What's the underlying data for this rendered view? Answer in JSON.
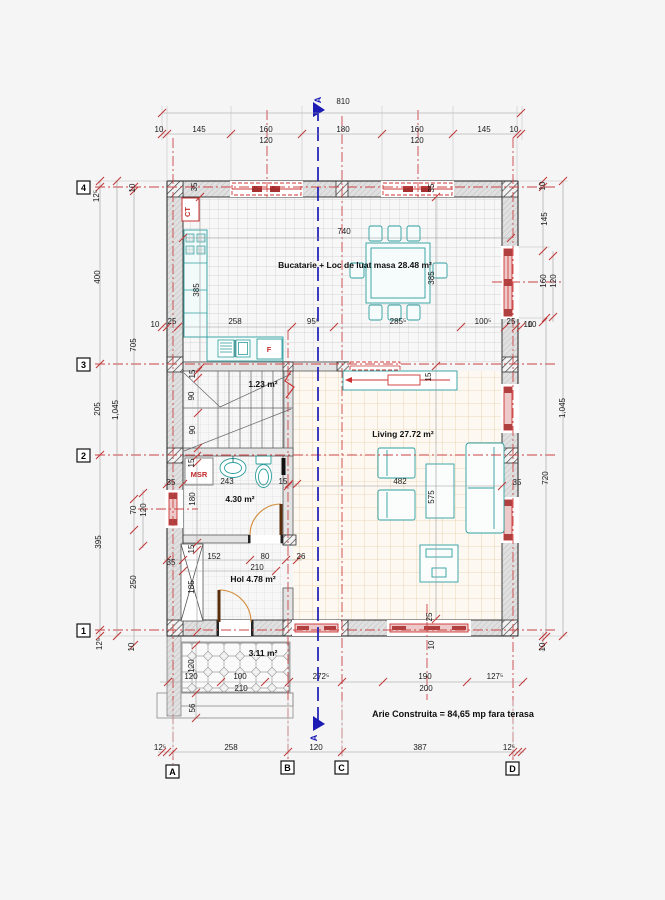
{
  "colors": {
    "axis_red": "#c23a3a",
    "section_blue": "#1c1cb4",
    "furniture_teal": "#2e9e9e",
    "door_orange": "#d28a36",
    "wall_gray": "#e0e0e0"
  },
  "rooms": {
    "kitchen": "Bucatarie + Loc de luat masa 28.48 m²",
    "stair": "1.23 m²",
    "living": "Living 27.72 m²",
    "bath": "4.30 m²",
    "hall": "Hol 4.78 m²",
    "terrace": "3.11 m²"
  },
  "note": "Arie Construita = 84,65 mp fara terasa",
  "labels": {
    "boiler": "CT",
    "fridge": "F",
    "washer": "MSR"
  },
  "section": {
    "top": "A",
    "bottom": "A"
  },
  "axes": {
    "cols": [
      "A",
      "B",
      "C",
      "D"
    ],
    "rows": [
      "4",
      "3",
      "2",
      "1"
    ]
  },
  "dims": {
    "top_total": "810",
    "top": [
      "10",
      "145",
      "160",
      "180",
      "160",
      "145",
      "10"
    ],
    "top_sub": [
      "120",
      "120"
    ],
    "kitchen_line": [
      "10",
      "25",
      "258",
      "95⁵",
      "285⁵",
      "100⁵",
      "25",
      "10"
    ],
    "left": [
      "12⁵",
      "10",
      "400",
      "705",
      "1,045",
      "205",
      "35",
      "70",
      "120",
      "35",
      "395",
      "250",
      "12⁵",
      "10"
    ],
    "right": [
      "10",
      "145",
      "160",
      "120",
      "10",
      "1,045",
      "35",
      "720",
      "10"
    ],
    "bottom_inner": [
      "120",
      "100",
      "210",
      "272⁵",
      "190",
      "200",
      "127⁵"
    ],
    "bottom_outer": [
      "12⁵",
      "258",
      "120",
      "387",
      "12⁵"
    ],
    "terrace": [
      "120",
      "56"
    ],
    "stair": [
      "15",
      "90",
      "90"
    ],
    "bath": [
      "243",
      "15",
      "15",
      "180"
    ],
    "hall": [
      "152",
      "80",
      "26",
      "210",
      "15",
      "185"
    ],
    "dining": [
      "740",
      "385",
      "385"
    ],
    "living": [
      "482",
      "575",
      "15"
    ],
    "walls": [
      "35",
      "35",
      "25",
      "10"
    ]
  }
}
